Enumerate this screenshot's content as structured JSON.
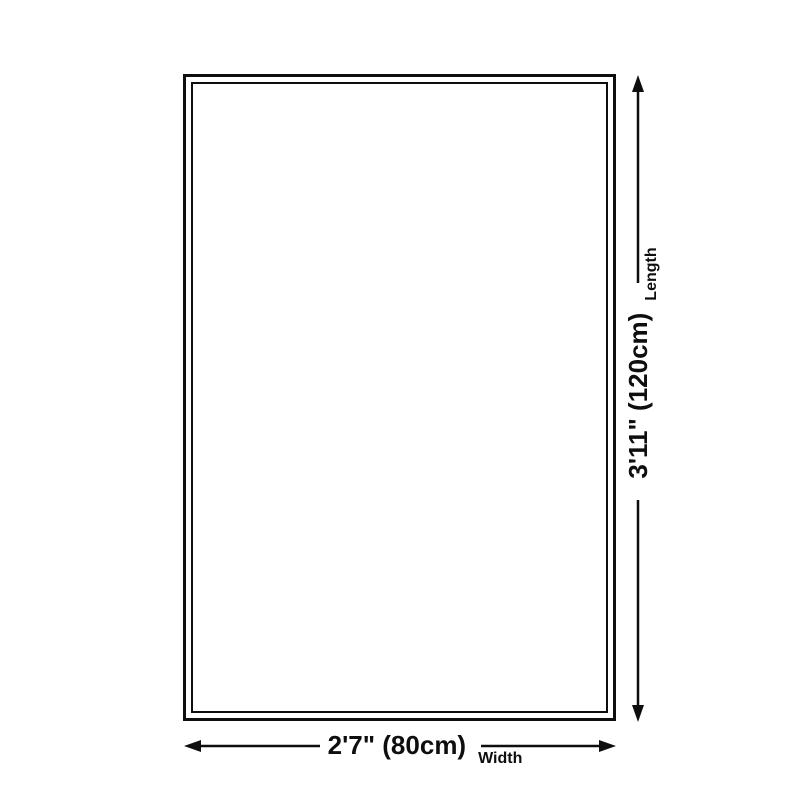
{
  "diagram": {
    "background_color": "#ffffff",
    "line_color": "#0e0e0e",
    "length": {
      "value": "3'11\" (120cm)",
      "label": "Length"
    },
    "width": {
      "value": "2'7\" (80cm)",
      "label": "Width"
    }
  }
}
